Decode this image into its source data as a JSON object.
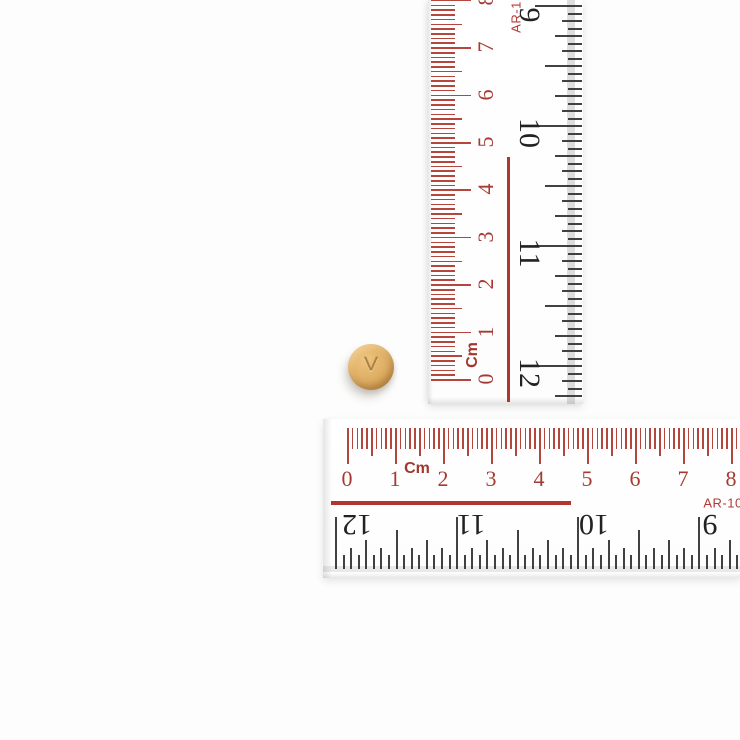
{
  "background": "#fdfdfd",
  "pill": {
    "imprint": "V",
    "body_color": "#ddac62",
    "highlight_color": "#eec47e",
    "rim_color": "#bf8e49",
    "imprint_color": "#ab8040",
    "center_x": 371,
    "center_y": 367,
    "diameter": 46
  },
  "vertical_ruler": {
    "unit_label": "Cm",
    "model_label": "AR-1",
    "cm_numbers": [
      "0",
      "1",
      "2",
      "3",
      "4",
      "5",
      "6",
      "7",
      "8"
    ],
    "inch_numbers": [
      "12",
      "11",
      "10",
      "9"
    ],
    "colors": {
      "tick": "#b5463d",
      "number": "#a63a32",
      "unit": "#a03830",
      "model": "#b23a35",
      "line": "#b0362f",
      "inch_tick": "#414141",
      "inch_number": "#222222"
    },
    "geometry": {
      "cm": {
        "origin": 379,
        "mm_step": 4.74,
        "mm_count": 80,
        "cm_step": 47.4,
        "tick_start": 3,
        "len_mm": 24,
        "len_half": 31,
        "len_cm": 40,
        "number_x": 58
      },
      "inch": {
        "origin": 365,
        "step": 7.5,
        "j_min": -5,
        "j_max": 48,
        "max_y": 402,
        "edge": 154,
        "len_1": 47,
        "len_2": 37,
        "len_4": 27,
        "len_8": 20,
        "len_16": 14,
        "number_x": 101,
        "number_y": [
          373,
          253,
          133,
          15
        ]
      }
    }
  },
  "horizontal_ruler": {
    "unit_label": "Cm",
    "model_label": "AR-10",
    "cm_numbers": [
      "0",
      "1",
      "2",
      "3",
      "4",
      "5",
      "6",
      "7",
      "8"
    ],
    "inch_numbers": [
      "12",
      "11",
      "10",
      "9"
    ],
    "colors": {
      "tick": "#b5463d",
      "number": "#a63a32",
      "unit": "#a03830",
      "model": "#b23a35",
      "line": "#b0362f",
      "inch_tick": "#414141",
      "inch_number": "#222222"
    },
    "geometry": {
      "cm": {
        "origin": 24,
        "mm_step": 4.8,
        "mm_count": 81,
        "cm_step": 48,
        "tick_top": 9,
        "len_mm": 21,
        "len_half": 28,
        "len_cm": 36,
        "number_y": 60
      },
      "inch": {
        "origin": 12,
        "step": 7.57,
        "j_min": 0,
        "j_max": 53,
        "max_x": 417,
        "baseline": 150,
        "len_1": 52,
        "len_2": 39,
        "len_4": 29,
        "len_8": 21,
        "len_16": 14,
        "number_y": 105,
        "number_x": [
          34,
          148,
          271,
          387
        ]
      }
    }
  }
}
